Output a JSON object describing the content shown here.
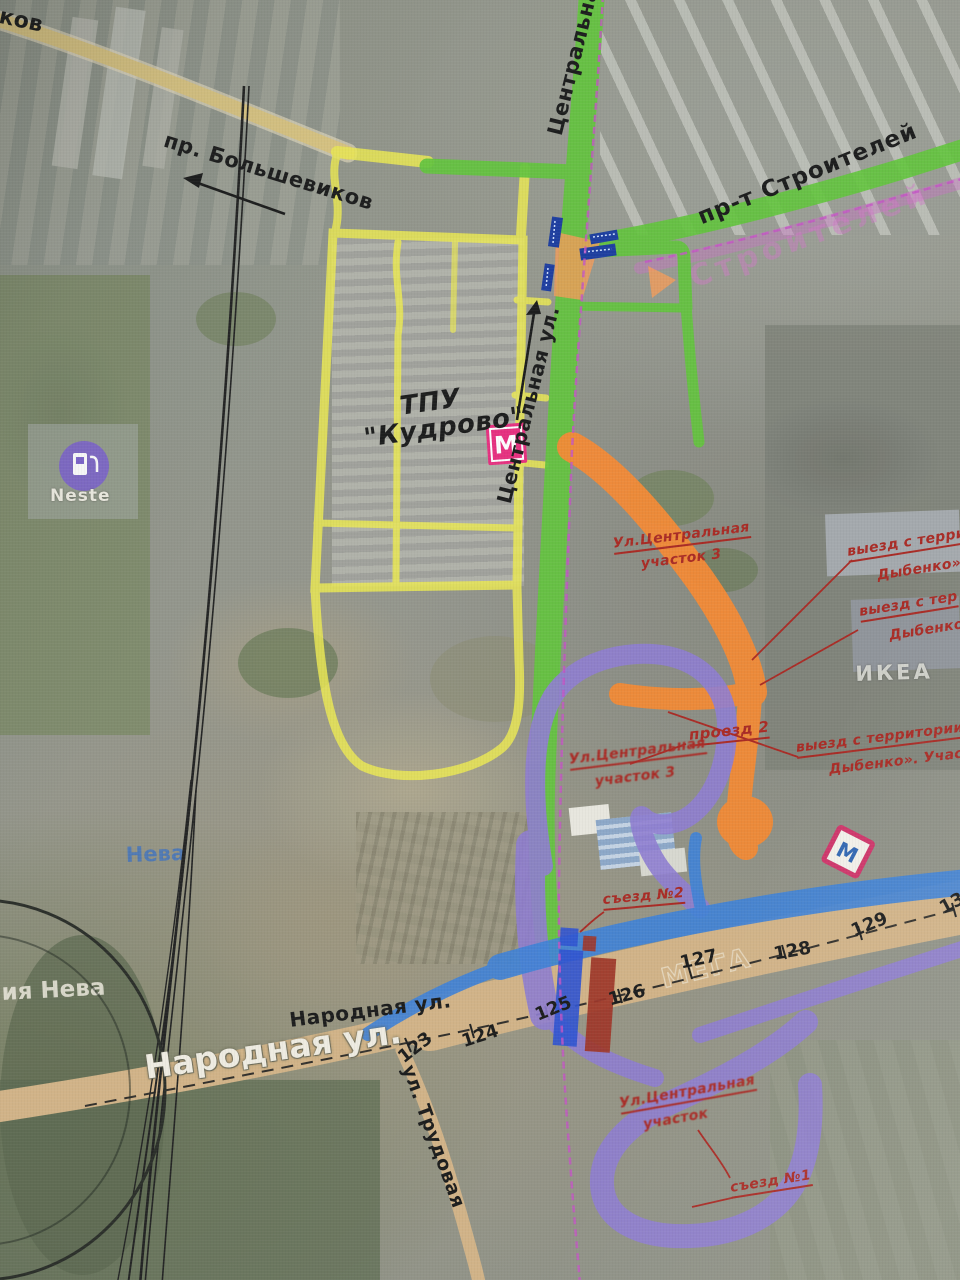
{
  "photo": {
    "corner_fragment": "ков",
    "streets": {
      "bolshevikov": "пр. Большевиков",
      "central_top": "Центральная",
      "stroiteley": "пр-т Строителей",
      "stroiteley_ghost": "Строителей",
      "central_mid": "Центральная ул.",
      "narodnaya_hand": "Народная ул.",
      "narodnaya_map": "Народная ул.",
      "trudovaya": "ул. Трудовая"
    },
    "tpu": {
      "line1": "ТПУ",
      "line2": "\"Кудрово\""
    },
    "annotations": {
      "central_sec3_line1": "Ул.Центральная",
      "central_sec3_line2": "участок 3",
      "exit1_line1": "выезд с терри",
      "exit1_line2": "Дыбенко».",
      "exit2_line1": "выезд с тер",
      "exit2_line2": "Дыбенко»",
      "exit3_line1": "выезд с территории",
      "exit3_line2": "Дыбенко». Участо",
      "proezd2": "проезд 2",
      "central_sec3b_line1": "Ул.Центральная",
      "central_sec3b_line2": "участок 3",
      "sezd2": "съезд №2",
      "central_bottom_line1": "Ул.Центральная",
      "central_bottom_line2": "участок",
      "sezd1": "съезд №1"
    },
    "km_markers": [
      "123",
      "124",
      "125",
      "126",
      "127",
      "128",
      "129",
      "13"
    ],
    "pois": {
      "neste": "Neste",
      "neva_blue": "Нева",
      "neva_white": "ия Нева",
      "ikea": "ИКЕА",
      "mega_ghost": "МЕГА",
      "metro_m": "М"
    },
    "colors": {
      "overlay_green": "#5fc338",
      "overlay_yellow": "#ece94f",
      "overlay_orange": "#f5862e",
      "overlay_purple": "#8d7ad0",
      "overlay_blue": "#3c7fd6",
      "annotation_red": "#a8231d",
      "metro_pink": "#e72a7c"
    }
  }
}
